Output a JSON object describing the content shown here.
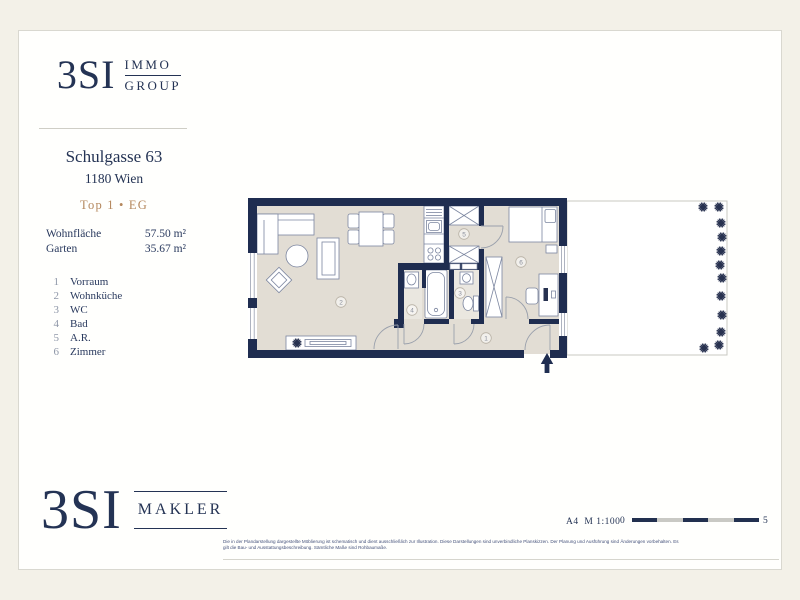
{
  "header_logo": {
    "brand": "3SI",
    "group_line1": "IMMO",
    "group_line2": "GROUP"
  },
  "project": {
    "title": "Schulgasse 63",
    "city": "1180 Wien",
    "unit_label": "Top 1 • EG"
  },
  "areas": {
    "rows": [
      {
        "label": "Wohnfläche",
        "value": "57.50 m²"
      },
      {
        "label": "Garten",
        "value": "35.67 m²"
      }
    ]
  },
  "legend": {
    "items": [
      {
        "num": "1",
        "label": "Vorraum"
      },
      {
        "num": "2",
        "label": "Wohnküche"
      },
      {
        "num": "3",
        "label": "WC"
      },
      {
        "num": "4",
        "label": "Bad"
      },
      {
        "num": "5",
        "label": "A.R."
      },
      {
        "num": "6",
        "label": "Zimmer"
      }
    ]
  },
  "plan": {
    "room_labels": [
      "1",
      "2",
      "3",
      "4",
      "5",
      "6"
    ]
  },
  "footer_logo": {
    "brand": "3SI",
    "word": "MAKLER"
  },
  "scale": {
    "format": "A4",
    "ratio": "M 1:100",
    "start": "0",
    "end": "5"
  },
  "disclaimer": {
    "line1": "Die in der Plandarstellung dargestellte Möblierung ist schematisch und dient ausschließlich zur Illustration. Diese Darstellungen sind unverbindliche Planskizzen. Der Planung und Ausführung sind Änderungen vorbehalten. Es",
    "line2": "gilt die Bau- und Ausstattungsbeschreibung. Sämtliche Maße sind Rohbaumaße."
  },
  "colors": {
    "navy": "#243354",
    "gold": "#b5885e",
    "wall": "#1f2d50",
    "floor": "#e2ddd4"
  }
}
